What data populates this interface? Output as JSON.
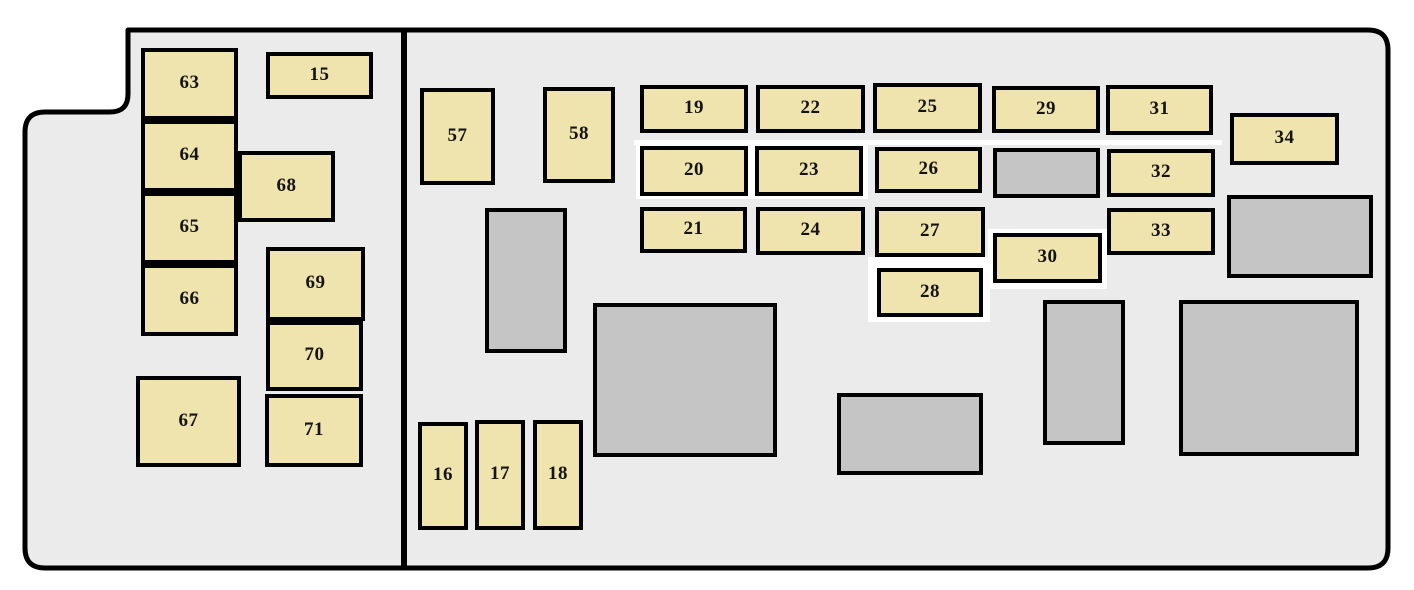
{
  "diagram": {
    "kind": "vehicle fuse box layout",
    "colors": {
      "page_background": "#ffffff",
      "panel_fill": "#ebebeb",
      "panel_border": "#000000",
      "fuse_fill": "#efe3ae",
      "relay_fill": "#c5c5c5",
      "label_color": "#141414",
      "patch_fill": "#ffffff"
    },
    "fuses": [
      {
        "label": "15",
        "x": 266,
        "y": 52,
        "w": 107,
        "h": 47
      },
      {
        "label": "16",
        "x": 418,
        "y": 422,
        "w": 50,
        "h": 108
      },
      {
        "label": "17",
        "x": 475,
        "y": 420,
        "w": 50,
        "h": 110
      },
      {
        "label": "18",
        "x": 533,
        "y": 420,
        "w": 50,
        "h": 110
      },
      {
        "label": "19",
        "x": 640,
        "y": 85,
        "w": 108,
        "h": 48
      },
      {
        "label": "20",
        "x": 640,
        "y": 146,
        "w": 108,
        "h": 50
      },
      {
        "label": "21",
        "x": 640,
        "y": 207,
        "w": 107,
        "h": 46
      },
      {
        "label": "22",
        "x": 756,
        "y": 85,
        "w": 109,
        "h": 48
      },
      {
        "label": "23",
        "x": 755,
        "y": 146,
        "w": 108,
        "h": 50
      },
      {
        "label": "24",
        "x": 756,
        "y": 207,
        "w": 109,
        "h": 48
      },
      {
        "label": "25",
        "x": 873,
        "y": 83,
        "w": 109,
        "h": 50
      },
      {
        "label": "26",
        "x": 875,
        "y": 147,
        "w": 107,
        "h": 46
      },
      {
        "label": "27",
        "x": 875,
        "y": 207,
        "w": 110,
        "h": 50
      },
      {
        "label": "28",
        "x": 877,
        "y": 268,
        "w": 106,
        "h": 49
      },
      {
        "label": "29",
        "x": 992,
        "y": 86,
        "w": 108,
        "h": 47
      },
      {
        "label": "30",
        "x": 993,
        "y": 233,
        "w": 109,
        "h": 50
      },
      {
        "label": "31",
        "x": 1106,
        "y": 85,
        "w": 107,
        "h": 50
      },
      {
        "label": "32",
        "x": 1107,
        "y": 149,
        "w": 108,
        "h": 48
      },
      {
        "label": "33",
        "x": 1107,
        "y": 208,
        "w": 108,
        "h": 47
      },
      {
        "label": "34",
        "x": 1230,
        "y": 113,
        "w": 109,
        "h": 52
      },
      {
        "label": "57",
        "x": 420,
        "y": 88,
        "w": 75,
        "h": 97
      },
      {
        "label": "58",
        "x": 543,
        "y": 87,
        "w": 72,
        "h": 96
      },
      {
        "label": "63",
        "x": 141,
        "y": 48,
        "w": 97,
        "h": 72
      },
      {
        "label": "64",
        "x": 141,
        "y": 120,
        "w": 97,
        "h": 72
      },
      {
        "label": "65",
        "x": 141,
        "y": 192,
        "w": 97,
        "h": 72
      },
      {
        "label": "66",
        "x": 141,
        "y": 264,
        "w": 97,
        "h": 72
      },
      {
        "label": "67",
        "x": 136,
        "y": 376,
        "w": 105,
        "h": 91
      },
      {
        "label": "68",
        "x": 238,
        "y": 151,
        "w": 97,
        "h": 71
      },
      {
        "label": "69",
        "x": 266,
        "y": 247,
        "w": 99,
        "h": 74
      },
      {
        "label": "70",
        "x": 266,
        "y": 321,
        "w": 97,
        "h": 70
      },
      {
        "label": "71",
        "x": 265,
        "y": 394,
        "w": 98,
        "h": 73
      }
    ],
    "relays": [
      {
        "x": 485,
        "y": 208,
        "w": 82,
        "h": 145
      },
      {
        "x": 993,
        "y": 148,
        "w": 107,
        "h": 50
      },
      {
        "x": 1227,
        "y": 195,
        "w": 146,
        "h": 83
      },
      {
        "x": 593,
        "y": 303,
        "w": 184,
        "h": 154
      },
      {
        "x": 837,
        "y": 393,
        "w": 146,
        "h": 82
      },
      {
        "x": 1043,
        "y": 300,
        "w": 82,
        "h": 145
      },
      {
        "x": 1179,
        "y": 300,
        "w": 180,
        "h": 156
      }
    ],
    "white_patches": [
      {
        "x": 634,
        "y": 140,
        "w": 588,
        "h": 5
      },
      {
        "x": 636,
        "y": 141,
        "w": 232,
        "h": 58
      },
      {
        "x": 868,
        "y": 257,
        "w": 122,
        "h": 65
      },
      {
        "x": 988,
        "y": 229,
        "w": 119,
        "h": 60
      }
    ],
    "outline": {
      "path": "M 128,30 L 1368,30 Q 1388,30 1388,50 L 1388,548 Q 1388,568 1368,568 L 45,568 Q 25,568 25,548 L 25,132 Q 25,112 45,112 L 110,112 Q 128,112 128,94 L 128,30 Z",
      "divider": {
        "x": 404,
        "y1": 28,
        "y2": 568,
        "width": 6
      },
      "stroke_width": 5
    }
  }
}
